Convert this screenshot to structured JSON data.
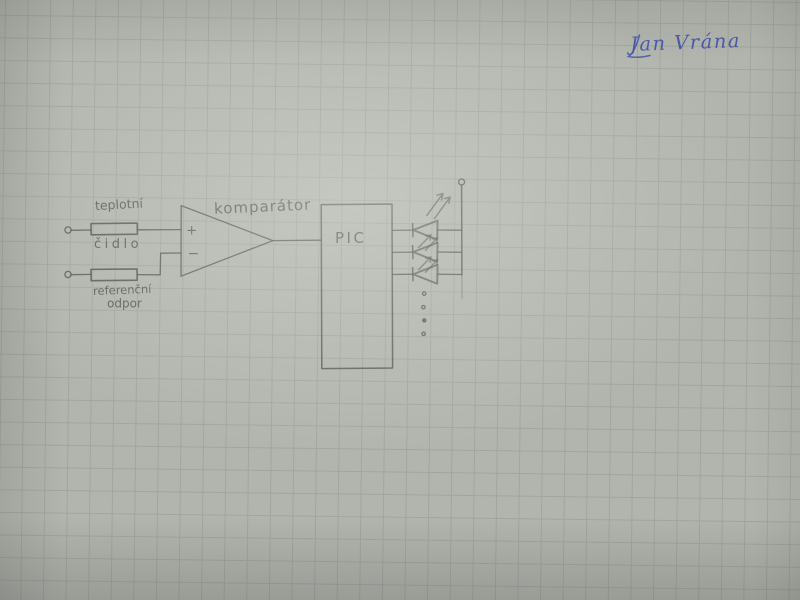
{
  "signature": {
    "name": "Jan Vrána"
  },
  "schematic": {
    "sensor": {
      "label_top": "teplotní",
      "label_bottom": "čidlo"
    },
    "reference": {
      "label_top": "referenční",
      "label_bottom": "odpor"
    },
    "comparator": {
      "label": "komparátor",
      "plus": "+",
      "minus": "−"
    },
    "mcu": {
      "label": "PIC"
    }
  },
  "colors": {
    "paper": "#b2b4ae",
    "grid_line": "#969a93",
    "pencil": "#4f4e48",
    "pen_ink": "#4050a8"
  }
}
